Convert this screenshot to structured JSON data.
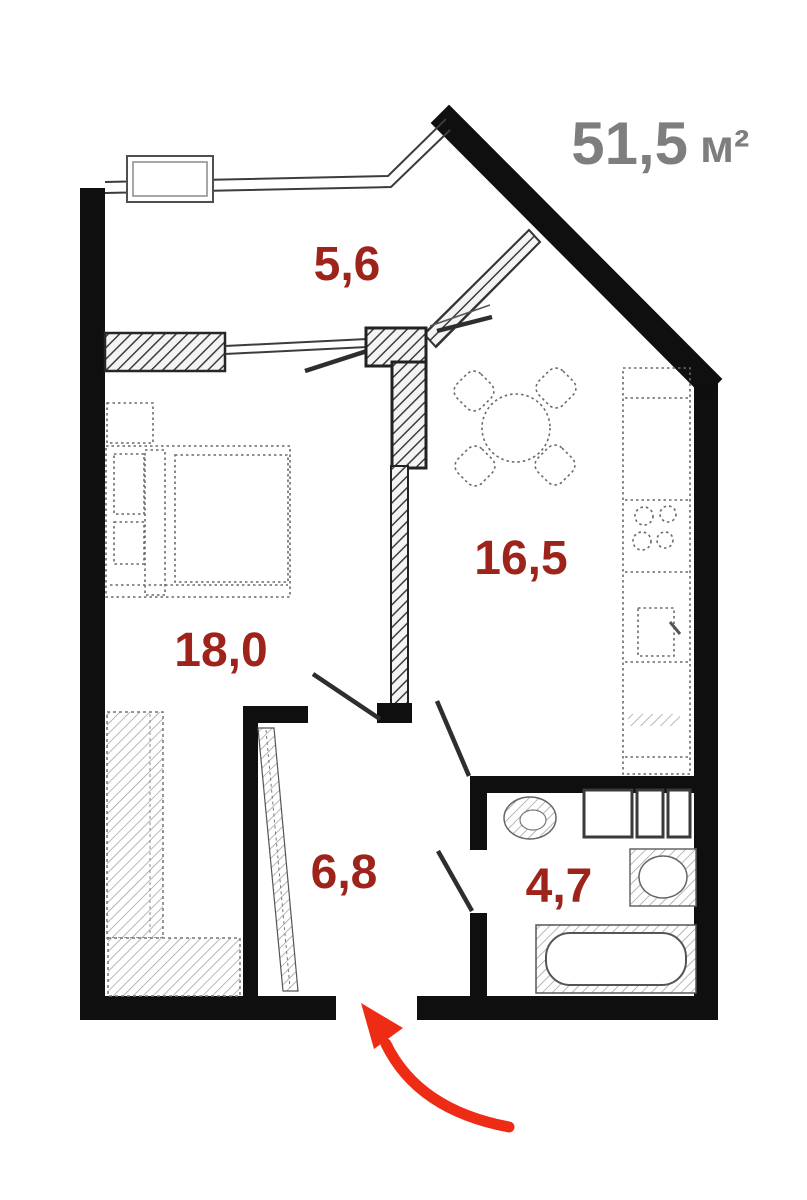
{
  "plan": {
    "total_area_value": "51,5",
    "total_area_unit": "м²",
    "rooms": {
      "balcony": "5,6",
      "living_room": "18,0",
      "kitchen": "16,5",
      "hallway": "6,8",
      "bathroom": "4,7"
    },
    "colors": {
      "wall": "#0f0f0f",
      "room_label": "#9e231b",
      "total_label": "#7e7e7e",
      "arrow": "#ee2c15"
    }
  }
}
